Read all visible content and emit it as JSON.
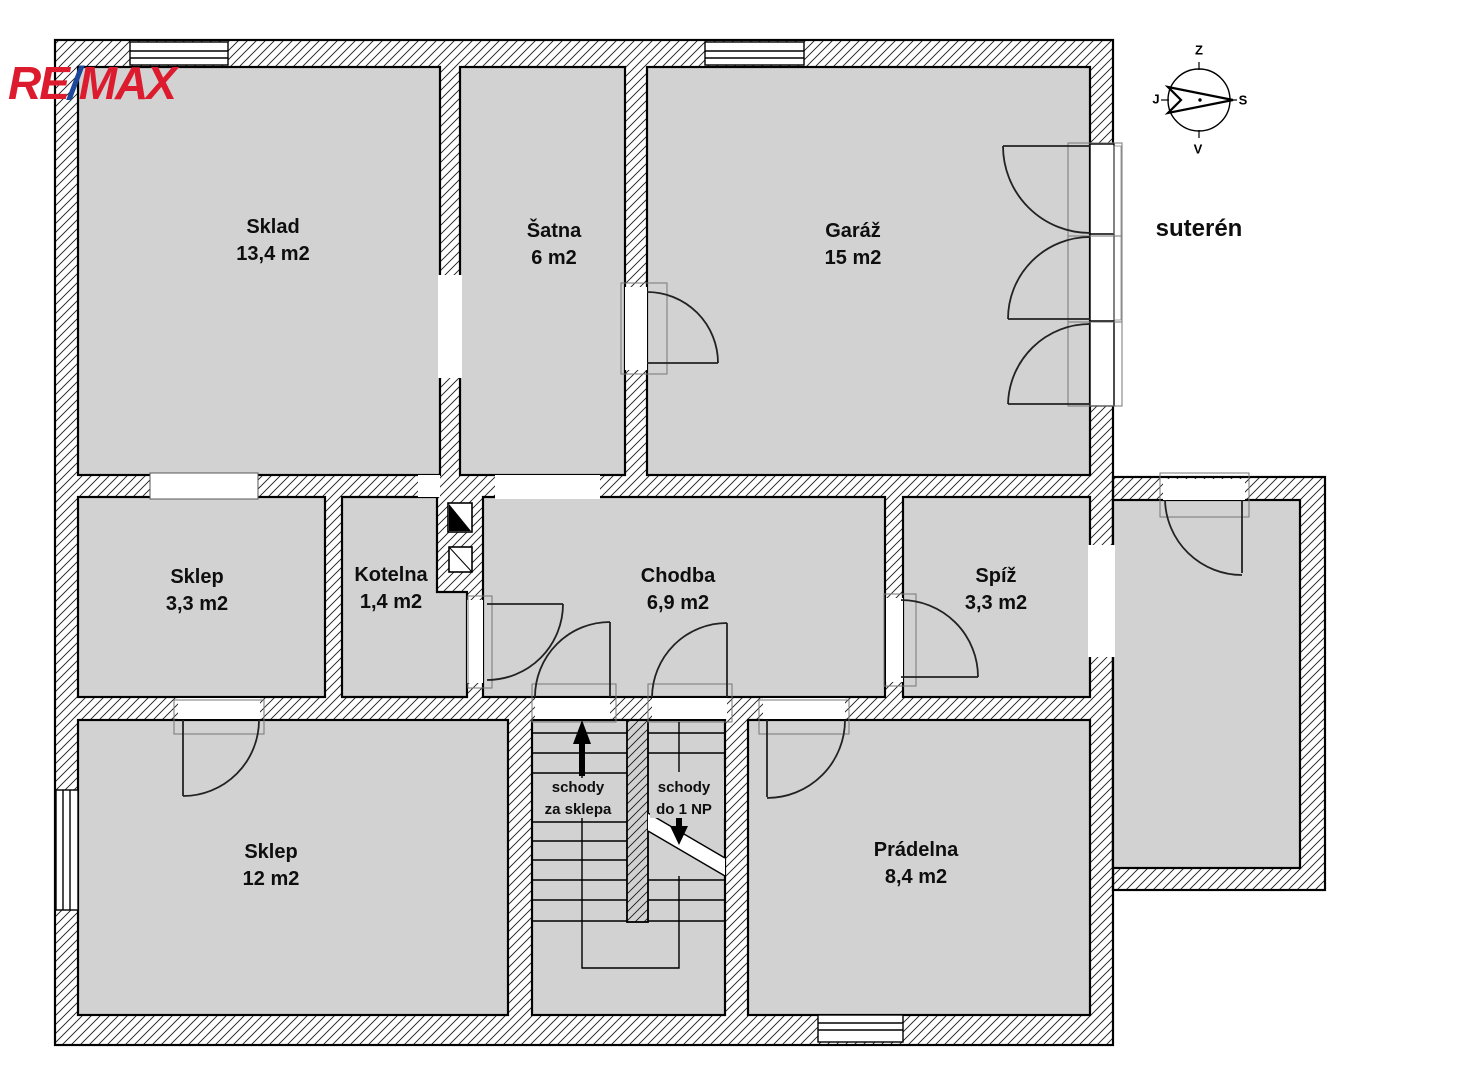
{
  "brand": {
    "re": "RE",
    "slash": "/",
    "max": "MAX"
  },
  "floor_label": "suterén",
  "compass": {
    "top": "Z",
    "right": "S",
    "bottom": "V",
    "left": "J"
  },
  "rooms": [
    {
      "id": "sklad",
      "name": "Sklad",
      "area": "13,4 m2"
    },
    {
      "id": "satna",
      "name": "Šatna",
      "area": "6 m2"
    },
    {
      "id": "garaz",
      "name": "Garáž",
      "area": "15 m2"
    },
    {
      "id": "sklep-maly",
      "name": "Sklep",
      "area": "3,3 m2"
    },
    {
      "id": "kotelna",
      "name": "Kotelna",
      "area": "1,4 m2"
    },
    {
      "id": "chodba",
      "name": "Chodba",
      "area": "6,9 m2"
    },
    {
      "id": "spiz",
      "name": "Spíž",
      "area": "3,3 m2"
    },
    {
      "id": "sklep-velky",
      "name": "Sklep",
      "area": "12 m2"
    },
    {
      "id": "pradelna",
      "name": "Prádelna",
      "area": "8,4 m2"
    }
  ],
  "stairs": [
    {
      "id": "schody-za-sklepa",
      "line1": "schody",
      "line2": "za sklepa",
      "direction": "up"
    },
    {
      "id": "schody-do-1np",
      "line1": "schody",
      "line2": "do 1 NP",
      "direction": "down"
    }
  ],
  "colors": {
    "room_fill": "#d2d2d2",
    "wall_line": "#000000",
    "brand_red": "#dc1c2e",
    "brand_blue": "#1b489b"
  }
}
